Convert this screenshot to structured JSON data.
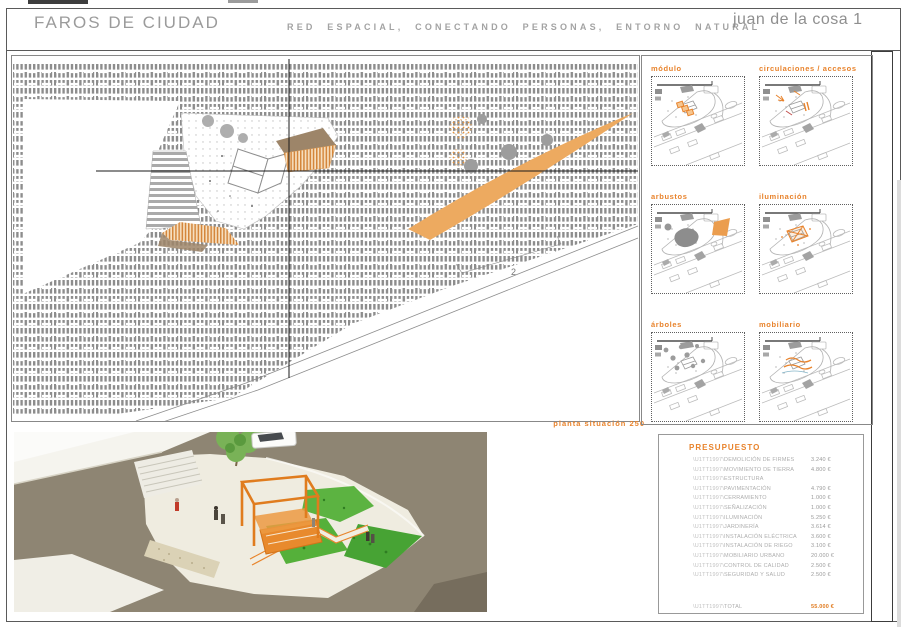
{
  "header": {
    "title": "FAROS DE CIUDAD",
    "subtitle": "RED ESPACIAL, CONECTANDO PERSONAS, ENTORNO NATURAL",
    "project": "juan de la cosa 1"
  },
  "plan": {
    "caption": "planta situación 250",
    "annotation": "2"
  },
  "panels": {
    "items": [
      {
        "label": "módulo"
      },
      {
        "label": "circulaciones / accesos"
      },
      {
        "label": "arbustos"
      },
      {
        "label": "iluminación"
      },
      {
        "label": "árboles"
      },
      {
        "label": "mobiliario"
      }
    ]
  },
  "budget": {
    "title": "PRESUPUESTO",
    "code_prefix": "\\U1TT1997\\",
    "items": [
      {
        "label": "DEMOLICIÓN DE FIRMES",
        "value": "3.240 €"
      },
      {
        "label": "MOVIMIENTO DE TIERRA",
        "value": "4.800 €"
      },
      {
        "label": "ESTRUCTURA",
        "value": ""
      },
      {
        "label": "PAVIMENTACIÓN",
        "value": "4.790 €"
      },
      {
        "label": "CERRAMIENTO",
        "value": "1.000 €"
      },
      {
        "label": "SEÑALIZACIÓN",
        "value": "1.000 €"
      },
      {
        "label": "ILUMINACIÓN",
        "value": "5.250 €"
      },
      {
        "label": "JARDINERÍA",
        "value": "3.614 €"
      },
      {
        "label": "INSTALACIÓN ELÉCTRICA",
        "value": "3.600 €"
      },
      {
        "label": "INSTALACIÓN DE RIEGO",
        "value": "3.100 €"
      },
      {
        "label": "MOBILIARIO URBANO",
        "value": "20.000 €"
      },
      {
        "label": "CONTROL DE CALIDAD",
        "value": "2.500 €"
      },
      {
        "label": "SEGURIDAD Y SALUD",
        "value": "2.500 €"
      }
    ],
    "total": {
      "label": "TOTAL",
      "value": "55.000 €"
    }
  },
  "colors": {
    "accent_orange": "#e8832c",
    "hatch_gray": "#8d8d8d",
    "header_gray": "#9b9b9b"
  }
}
